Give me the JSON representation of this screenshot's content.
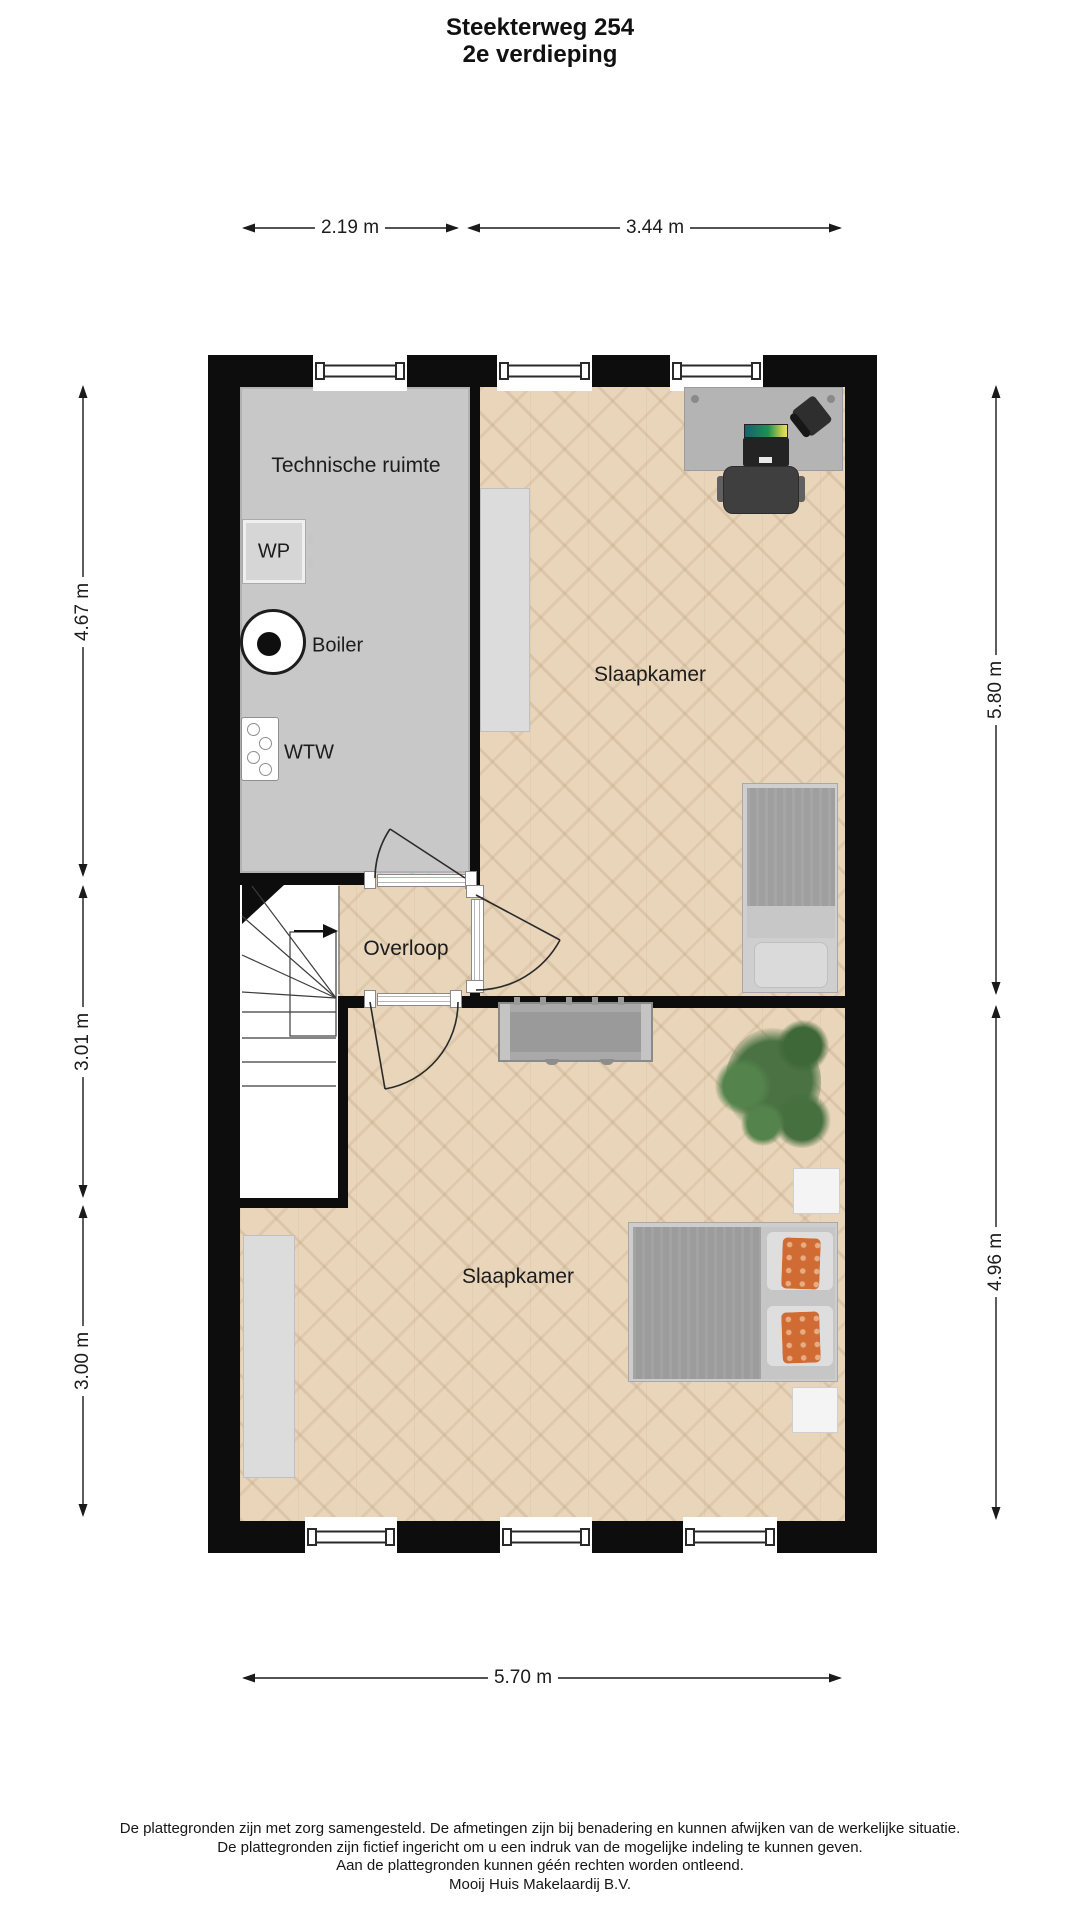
{
  "title": {
    "line1": "Steekterweg 254",
    "line2": "2e verdieping"
  },
  "rooms": {
    "technical_room": "Technische ruimte",
    "bedroom_top": "Slaapkamer",
    "landing": "Overloop",
    "bedroom_bottom": "Slaapkamer"
  },
  "appliances": {
    "heat_pump": "WP",
    "boiler": "Boiler",
    "heat_recovery": "WTW"
  },
  "dimensions": {
    "top_left": "2.19 m",
    "top_right": "3.44 m",
    "left_top": "4.67 m",
    "left_middle": "3.01 m",
    "left_bottom": "3.00 m",
    "right_top": "5.80 m",
    "right_bottom": "4.96 m",
    "bottom": "5.70 m"
  },
  "footer": {
    "line1": "De plattegronden zijn met zorg samengesteld. De afmetingen zijn bij benadering en kunnen afwijken van de werkelijke situatie.",
    "line2": "De plattegronden zijn fictief ingericht om u een indruk van de mogelijke indeling te kunnen geven.",
    "line3": "Aan de plattegronden kunnen géén rechten worden ontleend.",
    "line4": "Mooij Huis Makelaardij B.V."
  },
  "colors": {
    "wall": "#0d0d0d",
    "wood_floor": "#e8d5ba",
    "technical_floor": "#c8c8c8",
    "accent_pillow": "#d06c33",
    "plant": "#4a7243"
  }
}
